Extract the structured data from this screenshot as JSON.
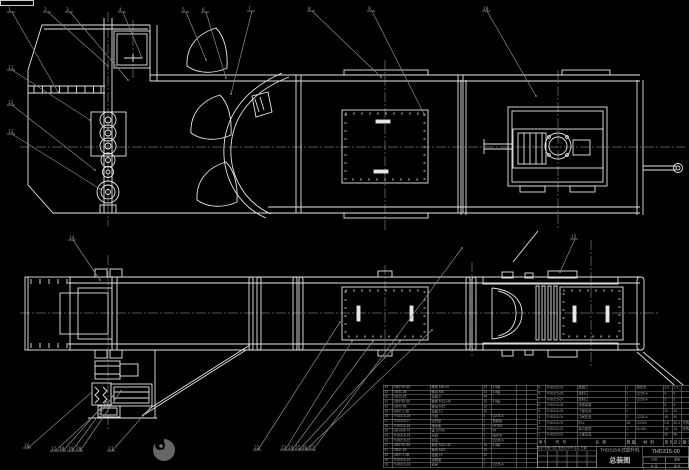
{
  "page": {
    "background": "#000000",
    "line_color": "#e6e6e6",
    "leader_color": "#8c8c8c",
    "table_line_color": "#8f8f8f",
    "text_color": "#9f9f9f"
  },
  "title_block": {
    "product_title": "THD315斗式提升机",
    "sheet_title": "总装图",
    "drawing_no": "THD315-00",
    "rev_header": "标记 处数 分区 更改文件号 签名 日期",
    "info_labels": [
      "比例",
      "重量",
      "共 张",
      "第 张"
    ]
  },
  "bom_right": {
    "header": [
      "序号",
      "代 号",
      "名 称",
      "数量",
      "材 料",
      "单件",
      "总计",
      "备注"
    ],
    "rows": [
      [
        "9",
        "THD315-09",
        "检视门",
        "1",
        "组合件",
        "2.5",
        "2.5",
        ""
      ],
      [
        "8",
        "THD315-08",
        "进料口",
        "1",
        "Q235-A",
        "6",
        "6",
        ""
      ],
      [
        "7",
        "THD315-07",
        "卸料口",
        "1",
        "Q235-A",
        "5",
        "5",
        ""
      ],
      [
        "6",
        "THD315-06",
        "张紧装置",
        "1",
        "",
        "8",
        "8",
        ""
      ],
      [
        "5",
        "THD315-05",
        "下部区段",
        "1",
        "",
        "32",
        "32",
        ""
      ],
      [
        "4",
        "THD315-04",
        "中间机壳",
        "2",
        "Q235-A",
        "45",
        "90",
        ""
      ],
      [
        "3",
        "THD315-03",
        "料斗",
        "38",
        "DX315",
        "0.8",
        "30.4",
        "外购"
      ],
      [
        "2",
        "THD315-02",
        "牵引胶带",
        "1",
        "B=160",
        "18",
        "18",
        "外购"
      ],
      [
        "1",
        "THD315-01",
        "上部区段",
        "1",
        "",
        "56",
        "56",
        ""
      ]
    ]
  },
  "bom_left": {
    "rows": [
      [
        "34",
        "GB5780-86",
        "螺栓 M8×25",
        "24",
        "4.8级",
        "",
        ""
      ],
      [
        "33",
        "GB41-86",
        "螺母 M8",
        "24",
        "4.8级",
        "",
        ""
      ],
      [
        "32",
        "GB95-85",
        "垫圈 8",
        "48",
        "",
        "",
        ""
      ],
      [
        "31",
        "GB5782-86",
        "螺栓 M12×45",
        "16",
        "4.8级",
        "",
        ""
      ],
      [
        "30",
        "GB41-86",
        "螺母 M12",
        "16",
        "",
        "",
        ""
      ],
      [
        "29",
        "GB97.1-85",
        "垫圈 12",
        "32",
        "",
        "",
        ""
      ],
      [
        "28",
        "THD315-28",
        "压板",
        "4",
        "Q235-A",
        "",
        ""
      ],
      [
        "27",
        "THD315-27",
        "密封垫",
        "2",
        "橡胶板",
        "",
        ""
      ],
      [
        "26",
        "THD315-26",
        "轴承座",
        "2",
        "HT200",
        "",
        ""
      ],
      [
        "25",
        "GB1096-79",
        "键 10×56",
        "2",
        "45",
        "",
        ""
      ],
      [
        "24",
        "THD315-24",
        "托辊",
        "2",
        "组合件",
        "",
        ""
      ],
      [
        "23",
        "THD315-23",
        "护罩",
        "1",
        "Q235-A",
        "",
        ""
      ],
      [
        "22",
        "GB5782-86",
        "螺栓 M10×35",
        "16",
        "4.8级",
        "",
        ""
      ],
      [
        "21",
        "GB41-86",
        "螺母 M10",
        "16",
        "",
        "",
        ""
      ],
      [
        "20",
        "GB97.1-85",
        "垫圈 10",
        "32",
        "",
        "",
        ""
      ],
      [
        "19",
        "THD315-19",
        "观察窗",
        "1",
        "",
        "",
        ""
      ],
      [
        "18",
        "THD315-18",
        "支座",
        "2",
        "Q235-A",
        "",
        ""
      ]
    ]
  },
  "callouts": [
    {
      "label": "1",
      "x": 10,
      "y": 10,
      "tx": 58,
      "ty": 92
    },
    {
      "label": "2",
      "x": 46,
      "y": 10,
      "tx": 108,
      "ty": 66
    },
    {
      "label": "3",
      "x": 68,
      "y": 10,
      "tx": 128,
      "ty": 80
    },
    {
      "label": "4",
      "x": 121,
      "y": 10,
      "tx": 142,
      "ty": 58
    },
    {
      "label": "5",
      "x": 184,
      "y": 10,
      "tx": 206,
      "ty": 60
    },
    {
      "label": "6",
      "x": 204,
      "y": 10,
      "tx": 226,
      "ty": 78
    },
    {
      "label": "7",
      "x": 250,
      "y": 9,
      "tx": 231,
      "ty": 94
    },
    {
      "label": "8",
      "x": 310,
      "y": 9,
      "tx": 381,
      "ty": 77
    },
    {
      "label": "9",
      "x": 370,
      "y": 9,
      "tx": 424,
      "ty": 114
    },
    {
      "label": "10",
      "x": 485,
      "y": 9,
      "tx": 536,
      "ty": 96
    },
    {
      "label": "11",
      "x": 10,
      "y": 68,
      "tx": 90,
      "ty": 120
    },
    {
      "label": "12",
      "x": 10,
      "y": 103,
      "tx": 95,
      "ty": 170
    },
    {
      "label": "13",
      "x": 10,
      "y": 132,
      "tx": 100,
      "ty": 189
    },
    {
      "label": "14",
      "x": 71,
      "y": 238,
      "tx": 100,
      "ty": 280
    },
    {
      "label": "15",
      "x": 573,
      "y": 237,
      "tx": 560,
      "ty": 272
    },
    {
      "label": "16",
      "x": 26,
      "y": 446,
      "tx": 92,
      "ty": 392
    },
    {
      "label": "17",
      "x": 53,
      "y": 449,
      "tx": 100,
      "ty": 410
    },
    {
      "label": "18",
      "x": 61,
      "y": 449,
      "tx": 106,
      "ty": 402
    },
    {
      "label": "19",
      "x": 70,
      "y": 449,
      "tx": 113,
      "ty": 396
    },
    {
      "label": "20",
      "x": 78,
      "y": 449,
      "tx": 121,
      "ty": 391
    },
    {
      "label": "21",
      "x": 110,
      "y": 449,
      "tx": 150,
      "ty": 408
    },
    {
      "label": "22",
      "x": 256,
      "y": 448,
      "tx": 340,
      "ty": 322
    },
    {
      "label": "23",
      "x": 283,
      "y": 448,
      "tx": 352,
      "ty": 341
    },
    {
      "label": "24",
      "x": 290,
      "y": 448,
      "tx": 373,
      "ty": 341
    },
    {
      "label": "25",
      "x": 297,
      "y": 448,
      "tx": 400,
      "ty": 341
    },
    {
      "label": "26",
      "x": 304,
      "y": 448,
      "tx": 432,
      "ty": 330
    },
    {
      "label": "27",
      "x": 311,
      "y": 448,
      "tx": 462,
      "ty": 248
    }
  ]
}
